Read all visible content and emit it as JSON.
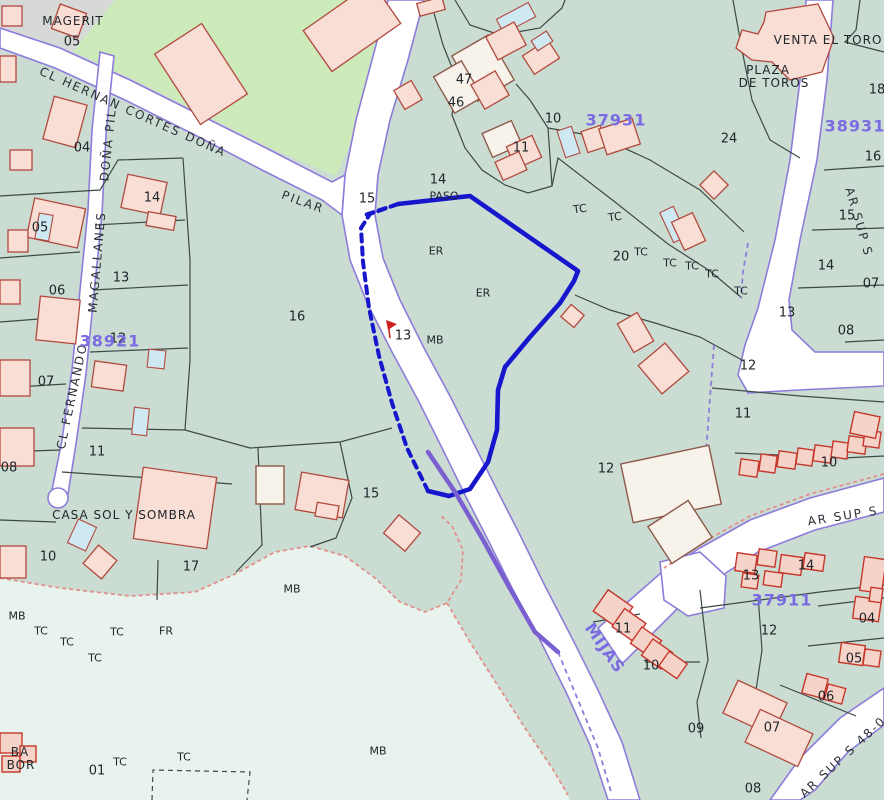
{
  "map": {
    "title": "cadastral-parcel-map",
    "colors": {
      "parcel_fill": "#cbdcd3",
      "light_zone_fill": "#e7f3ec",
      "park_fill": "#cdeabb",
      "gray_block_fill": "#d6d9d6",
      "road_fill": "#ffffff",
      "road_edge": "#8d7cda",
      "boundary": "#3c4a44",
      "building_fill": "#f8ded4",
      "building_stroke": "#b2493e",
      "pool_fill": "#cfe9f2",
      "highlight_parcel": "#1616cd",
      "sheet_number": "#7b6ce2",
      "red_dashed_line": "#e2908c",
      "label_text": "#20262b"
    },
    "labels": [
      {
        "t": "MAGERIT",
        "x": 73,
        "y": 21,
        "k": "name"
      },
      {
        "t": "05",
        "x": 72,
        "y": 42,
        "k": "parcel"
      },
      {
        "t": "04",
        "x": 82,
        "y": 148,
        "k": "parcel"
      },
      {
        "t": "14",
        "x": 152,
        "y": 198,
        "k": "parcel"
      },
      {
        "t": "05",
        "x": 40,
        "y": 228,
        "k": "parcel"
      },
      {
        "t": "06",
        "x": 57,
        "y": 291,
        "k": "parcel"
      },
      {
        "t": "13",
        "x": 121,
        "y": 278,
        "k": "parcel"
      },
      {
        "t": "12",
        "x": 118,
        "y": 339,
        "k": "parcel"
      },
      {
        "t": "07",
        "x": 46,
        "y": 382,
        "k": "parcel"
      },
      {
        "t": "08",
        "x": 9,
        "y": 468,
        "k": "parcel"
      },
      {
        "t": "11",
        "x": 97,
        "y": 452,
        "k": "parcel"
      },
      {
        "t": "10",
        "x": 48,
        "y": 557,
        "k": "parcel"
      },
      {
        "t": "17",
        "x": 191,
        "y": 567,
        "k": "parcel"
      },
      {
        "t": "16",
        "x": 297,
        "y": 317,
        "k": "parcel"
      },
      {
        "t": "15",
        "x": 367,
        "y": 199,
        "k": "parcel"
      },
      {
        "t": "15",
        "x": 371,
        "y": 494,
        "k": "parcel"
      },
      {
        "t": "14",
        "x": 438,
        "y": 180,
        "k": "parcel"
      },
      {
        "t": "47",
        "x": 464,
        "y": 80,
        "k": "parcel"
      },
      {
        "t": "46",
        "x": 456,
        "y": 103,
        "k": "parcel"
      },
      {
        "t": "10",
        "x": 553,
        "y": 119,
        "k": "parcel"
      },
      {
        "t": "11",
        "x": 521,
        "y": 148,
        "k": "parcel"
      },
      {
        "t": "13",
        "x": 403,
        "y": 336,
        "k": "parcel"
      },
      {
        "t": "24",
        "x": 729,
        "y": 139,
        "k": "parcel"
      },
      {
        "t": "20",
        "x": 621,
        "y": 257,
        "k": "parcel"
      },
      {
        "t": "18",
        "x": 877,
        "y": 90,
        "k": "parcel"
      },
      {
        "t": "16",
        "x": 873,
        "y": 157,
        "k": "parcel"
      },
      {
        "t": "15",
        "x": 847,
        "y": 216,
        "k": "parcel"
      },
      {
        "t": "14",
        "x": 826,
        "y": 266,
        "k": "parcel"
      },
      {
        "t": "07",
        "x": 871,
        "y": 284,
        "k": "parcel"
      },
      {
        "t": "13",
        "x": 787,
        "y": 313,
        "k": "parcel"
      },
      {
        "t": "08",
        "x": 846,
        "y": 331,
        "k": "parcel"
      },
      {
        "t": "12",
        "x": 748,
        "y": 366,
        "k": "parcel"
      },
      {
        "t": "11",
        "x": 743,
        "y": 414,
        "k": "parcel"
      },
      {
        "t": "12",
        "x": 606,
        "y": 469,
        "k": "parcel"
      },
      {
        "t": "10",
        "x": 829,
        "y": 463,
        "k": "parcel"
      },
      {
        "t": "13",
        "x": 751,
        "y": 576,
        "k": "parcel"
      },
      {
        "t": "14",
        "x": 806,
        "y": 566,
        "k": "parcel"
      },
      {
        "t": "12",
        "x": 769,
        "y": 631,
        "k": "parcel"
      },
      {
        "t": "11",
        "x": 623,
        "y": 629,
        "k": "parcel"
      },
      {
        "t": "10",
        "x": 651,
        "y": 666,
        "k": "parcel"
      },
      {
        "t": "04",
        "x": 867,
        "y": 619,
        "k": "parcel"
      },
      {
        "t": "05",
        "x": 854,
        "y": 659,
        "k": "parcel"
      },
      {
        "t": "06",
        "x": 826,
        "y": 697,
        "k": "parcel"
      },
      {
        "t": "07",
        "x": 772,
        "y": 728,
        "k": "parcel"
      },
      {
        "t": "09",
        "x": 696,
        "y": 729,
        "k": "parcel"
      },
      {
        "t": "08",
        "x": 753,
        "y": 789,
        "k": "parcel"
      },
      {
        "t": "01",
        "x": 97,
        "y": 771,
        "k": "parcel"
      },
      {
        "t": "ER",
        "x": 436,
        "y": 251,
        "k": "code"
      },
      {
        "t": "ER",
        "x": 483,
        "y": 293,
        "k": "code"
      },
      {
        "t": "MB",
        "x": 435,
        "y": 340,
        "k": "code"
      },
      {
        "t": "MB",
        "x": 292,
        "y": 589,
        "k": "code"
      },
      {
        "t": "MB",
        "x": 17,
        "y": 616,
        "k": "code"
      },
      {
        "t": "MB",
        "x": 378,
        "y": 751,
        "k": "code"
      },
      {
        "t": "FR",
        "x": 166,
        "y": 631,
        "k": "code"
      },
      {
        "t": "TC",
        "x": 580,
        "y": 209,
        "k": "code",
        "r": -8
      },
      {
        "t": "TC",
        "x": 615,
        "y": 217,
        "k": "code",
        "r": -8
      },
      {
        "t": "TC",
        "x": 641,
        "y": 252,
        "k": "code"
      },
      {
        "t": "TC",
        "x": 670,
        "y": 263,
        "k": "code"
      },
      {
        "t": "TC",
        "x": 692,
        "y": 266,
        "k": "code"
      },
      {
        "t": "TC",
        "x": 712,
        "y": 274,
        "k": "code"
      },
      {
        "t": "TC",
        "x": 741,
        "y": 291,
        "k": "code"
      },
      {
        "t": "TC",
        "x": 41,
        "y": 631,
        "k": "code"
      },
      {
        "t": "TC",
        "x": 67,
        "y": 642,
        "k": "code"
      },
      {
        "t": "TC",
        "x": 95,
        "y": 658,
        "k": "code"
      },
      {
        "t": "TC",
        "x": 117,
        "y": 632,
        "k": "code"
      },
      {
        "t": "TC",
        "x": 120,
        "y": 762,
        "k": "code"
      },
      {
        "t": "TC",
        "x": 184,
        "y": 757,
        "k": "code"
      },
      {
        "t": "PASO",
        "x": 444,
        "y": 196,
        "k": "code"
      },
      {
        "t": "VENTA EL TORO",
        "x": 828,
        "y": 40,
        "k": "name",
        "s": 11
      },
      {
        "t": "PLAZA",
        "x": 768,
        "y": 70,
        "k": "name",
        "s": 11
      },
      {
        "t": "DE TOROS",
        "x": 774,
        "y": 83,
        "k": "name",
        "s": 11
      },
      {
        "t": "CASA SOL Y SOMBRA",
        "x": 124,
        "y": 515,
        "k": "name",
        "s": 11
      },
      {
        "t": "BA",
        "x": 20,
        "y": 752,
        "k": "name",
        "s": 10
      },
      {
        "t": "BOR",
        "x": 21,
        "y": 765,
        "k": "name",
        "s": 11
      },
      {
        "t": "CL HERNAN CORTES DOÑA",
        "x": 133,
        "y": 112,
        "k": "street",
        "r": 24
      },
      {
        "t": "PILAR",
        "x": 303,
        "y": 202,
        "k": "street",
        "r": 20
      },
      {
        "t": "DOÑA PIL",
        "x": 108,
        "y": 145,
        "k": "street",
        "r": -84
      },
      {
        "t": "MAGALLANES",
        "x": 97,
        "y": 262,
        "k": "street",
        "r": -85
      },
      {
        "t": "CL FERNANDO",
        "x": 72,
        "y": 396,
        "k": "street",
        "r": -78
      },
      {
        "t": "AR SUP S",
        "x": 859,
        "y": 222,
        "k": "street",
        "r": 74
      },
      {
        "t": "AR SUP S",
        "x": 843,
        "y": 516,
        "k": "street",
        "r": -9
      },
      {
        "t": "AR SUP S 48-0",
        "x": 843,
        "y": 757,
        "k": "street",
        "r": -43
      },
      {
        "t": "37931",
        "x": 616,
        "y": 120,
        "k": "sheet"
      },
      {
        "t": "38931",
        "x": 855,
        "y": 126,
        "k": "sheet"
      },
      {
        "t": "37911",
        "x": 782,
        "y": 600,
        "k": "sheet",
        "s": 15
      },
      {
        "t": "38921",
        "x": 110,
        "y": 341,
        "k": "sheet",
        "s": 14
      },
      {
        "t": "MIJAS",
        "x": 605,
        "y": 648,
        "k": "sheet",
        "s": 13,
        "r": 55
      }
    ],
    "buildings": [
      [
        2,
        6,
        20,
        20,
        0,
        "p"
      ],
      [
        55,
        8,
        28,
        26,
        20,
        "p"
      ],
      [
        173,
        32,
        56,
        84,
        -33,
        "p"
      ],
      [
        310,
        2,
        84,
        50,
        -35,
        "p"
      ],
      [
        48,
        100,
        34,
        44,
        15,
        "p"
      ],
      [
        0,
        56,
        16,
        26,
        0,
        "p"
      ],
      [
        30,
        203,
        52,
        40,
        12,
        "p"
      ],
      [
        37,
        214,
        14,
        26,
        10,
        "c"
      ],
      [
        124,
        178,
        40,
        34,
        12,
        "p"
      ],
      [
        147,
        214,
        28,
        14,
        10,
        "p"
      ],
      [
        10,
        150,
        22,
        20,
        0,
        "p"
      ],
      [
        8,
        230,
        20,
        22,
        0,
        "p"
      ],
      [
        38,
        298,
        40,
        44,
        6,
        "p"
      ],
      [
        0,
        280,
        20,
        24,
        0,
        "p"
      ],
      [
        0,
        360,
        30,
        36,
        0,
        "p"
      ],
      [
        93,
        363,
        32,
        26,
        8,
        "p"
      ],
      [
        133,
        408,
        15,
        27,
        6,
        "c"
      ],
      [
        148,
        350,
        17,
        18,
        6,
        "c"
      ],
      [
        0,
        428,
        34,
        38,
        0,
        "p"
      ],
      [
        138,
        472,
        74,
        72,
        8,
        "p"
      ],
      [
        72,
        522,
        20,
        26,
        25,
        "c"
      ],
      [
        88,
        550,
        24,
        24,
        40,
        "p"
      ],
      [
        0,
        546,
        26,
        32,
        0,
        "p"
      ],
      [
        256,
        466,
        28,
        38,
        0,
        "w"
      ],
      [
        298,
        476,
        48,
        38,
        10,
        "p"
      ],
      [
        316,
        504,
        22,
        14,
        10,
        "p"
      ],
      [
        388,
        521,
        28,
        24,
        40,
        "p"
      ],
      [
        462,
        42,
        42,
        52,
        -30,
        "w"
      ],
      [
        442,
        66,
        32,
        42,
        -30,
        "w"
      ],
      [
        476,
        76,
        28,
        28,
        -30,
        "p"
      ],
      [
        398,
        84,
        20,
        22,
        -30,
        "p"
      ],
      [
        498,
        10,
        36,
        16,
        -28,
        "c"
      ],
      [
        490,
        28,
        32,
        26,
        -28,
        "p"
      ],
      [
        526,
        46,
        30,
        22,
        -33,
        "p"
      ],
      [
        533,
        35,
        18,
        12,
        -33,
        "c"
      ],
      [
        486,
        126,
        32,
        26,
        -24,
        "w"
      ],
      [
        510,
        140,
        28,
        24,
        -24,
        "p"
      ],
      [
        498,
        156,
        26,
        20,
        -24,
        "p"
      ],
      [
        561,
        128,
        15,
        28,
        -18,
        "c"
      ],
      [
        584,
        128,
        20,
        22,
        -18,
        "p"
      ],
      [
        602,
        123,
        35,
        27,
        -18,
        "p"
      ],
      [
        704,
        175,
        20,
        20,
        45,
        "p"
      ],
      [
        666,
        208,
        15,
        33,
        -25,
        "c"
      ],
      [
        677,
        216,
        23,
        31,
        -25,
        "p"
      ],
      [
        564,
        308,
        17,
        16,
        40,
        "p"
      ],
      [
        624,
        316,
        23,
        33,
        -30,
        "p"
      ],
      [
        646,
        350,
        35,
        37,
        -40,
        "p"
      ],
      [
        626,
        454,
        90,
        60,
        -12,
        "w"
      ],
      [
        656,
        510,
        48,
        44,
        -33,
        "w"
      ],
      [
        418,
        0,
        26,
        13,
        -15,
        "p"
      ],
      [
        740,
        460,
        18,
        16,
        8,
        "d"
      ],
      [
        760,
        455,
        16,
        17,
        8,
        "d"
      ],
      [
        778,
        452,
        18,
        16,
        8,
        "d"
      ],
      [
        797,
        449,
        16,
        16,
        8,
        "d"
      ],
      [
        814,
        446,
        18,
        16,
        8,
        "d"
      ],
      [
        832,
        442,
        16,
        16,
        8,
        "d"
      ],
      [
        848,
        437,
        18,
        16,
        8,
        "d"
      ],
      [
        864,
        431,
        16,
        16,
        8,
        "d"
      ],
      [
        852,
        414,
        26,
        22,
        12,
        "d"
      ],
      [
        736,
        554,
        20,
        18,
        8,
        "d"
      ],
      [
        758,
        550,
        18,
        16,
        8,
        "d"
      ],
      [
        780,
        556,
        22,
        18,
        8,
        "d"
      ],
      [
        804,
        554,
        20,
        16,
        8,
        "d"
      ],
      [
        742,
        574,
        16,
        14,
        8,
        "d"
      ],
      [
        764,
        572,
        18,
        14,
        8,
        "d"
      ],
      [
        862,
        558,
        22,
        34,
        8,
        "d"
      ],
      [
        598,
        596,
        30,
        26,
        35,
        "d"
      ],
      [
        616,
        614,
        26,
        22,
        35,
        "d"
      ],
      [
        634,
        632,
        24,
        20,
        35,
        "d"
      ],
      [
        645,
        644,
        24,
        20,
        35,
        "d"
      ],
      [
        662,
        656,
        22,
        18,
        35,
        "d"
      ],
      [
        854,
        598,
        26,
        22,
        8,
        "d"
      ],
      [
        870,
        588,
        12,
        14,
        8,
        "d"
      ],
      [
        840,
        644,
        24,
        20,
        8,
        "d"
      ],
      [
        864,
        650,
        16,
        16,
        8,
        "d"
      ],
      [
        804,
        676,
        22,
        20,
        15,
        "d"
      ],
      [
        826,
        686,
        18,
        16,
        15,
        "d"
      ],
      [
        728,
        690,
        54,
        36,
        25,
        "p"
      ],
      [
        750,
        720,
        58,
        36,
        25,
        "p"
      ],
      [
        0,
        733,
        22,
        20,
        0,
        "d"
      ],
      [
        20,
        746,
        16,
        16,
        0,
        "d"
      ],
      [
        2,
        756,
        18,
        16,
        0,
        "d"
      ]
    ]
  }
}
